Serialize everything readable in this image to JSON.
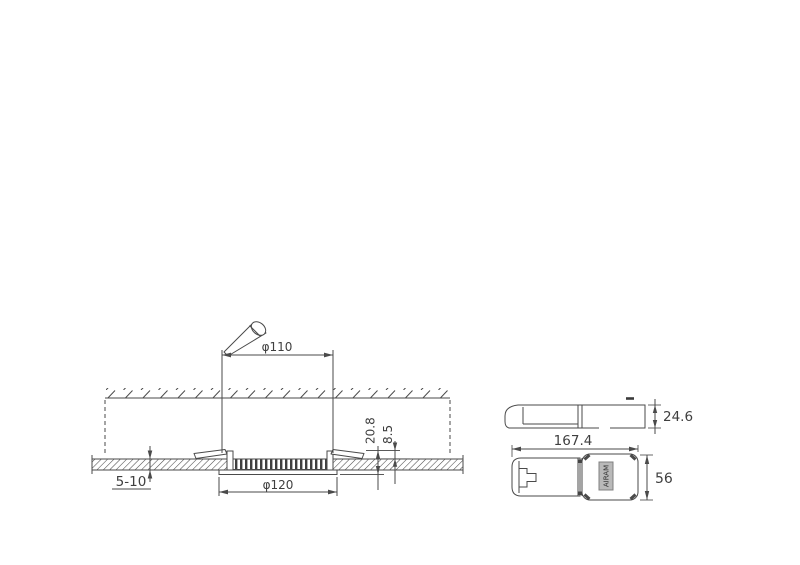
{
  "drawing": {
    "installation_section": {
      "cutout_dia": "φ110",
      "trim_dia": "φ120",
      "panel_thickness": "5-10",
      "height_total": "20.8",
      "height_above_ceiling": "8.5"
    },
    "driver": {
      "length": "167.4",
      "height": "24.6",
      "width": "56",
      "brand_label": "AIRAM"
    },
    "colors": {
      "line": "#4a4a4a",
      "text": "#3f3f3f",
      "label_fill": "#b9b9b9",
      "label_stroke": "#808080",
      "background": "#ffffff"
    }
  }
}
